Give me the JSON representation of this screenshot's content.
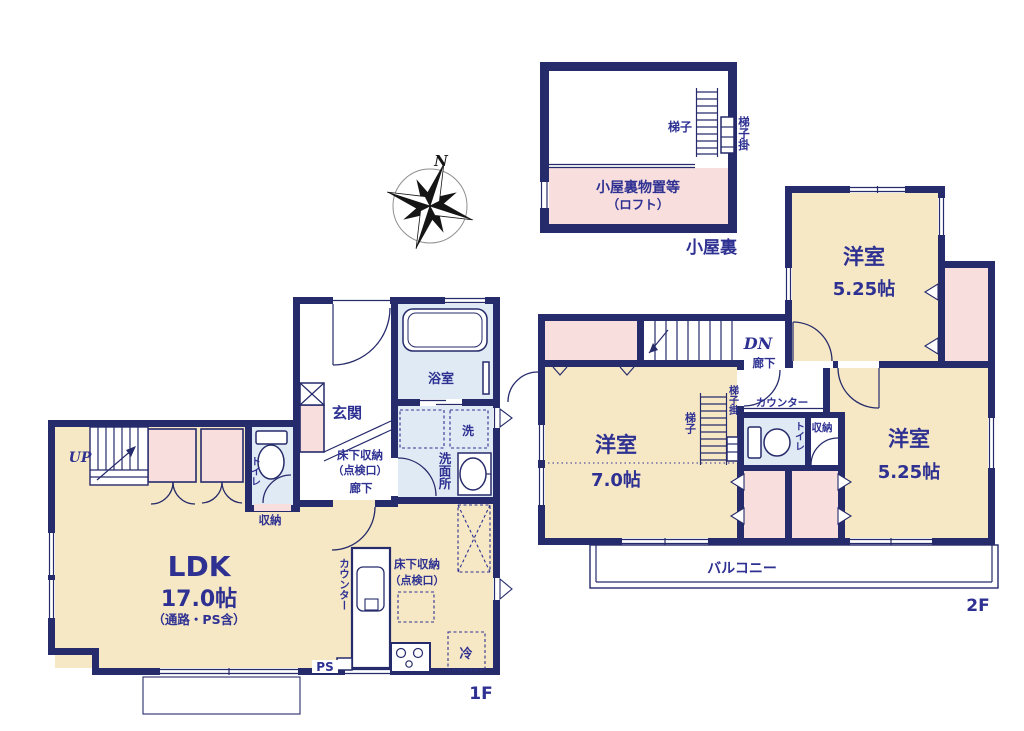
{
  "colors": {
    "wall": "#262b6b",
    "text": "#2e3192",
    "room_cream": "#f6e8c5",
    "closet_pink": "#f8dfde",
    "wet_area_blue": "#dfeaf4",
    "compass_black": "#151515"
  },
  "compass": {
    "north_label": "N"
  },
  "attic": {
    "name_label": "小屋裏",
    "storage_label": "小屋裏物置等",
    "storage_sub_label": "（ロフト）",
    "ladder_label": "梯子",
    "ladder_hook_label": "梯子掛"
  },
  "floor2": {
    "name_label": "2F",
    "rooms": [
      {
        "name": "洋室",
        "size": "5.25帖"
      },
      {
        "name": "洋室",
        "size": "7.0帖"
      },
      {
        "name": "洋室",
        "size": "5.25帖"
      }
    ],
    "stairs_label": "DN",
    "hallway_label": "廊下",
    "counter_label": "カウンター",
    "toilet_label": "トイレ",
    "closet_label": "収納",
    "ladder_label": "梯子",
    "ladder_hook_label": "梯子掛",
    "balcony_label": "バルコニー"
  },
  "floor1": {
    "name_label": "1F",
    "ldk": {
      "name": "LDK",
      "size": "17.0帖",
      "note": "（通路・PS含）"
    },
    "stairs_label": "UP",
    "entrance_label": "玄関",
    "bath_label": "浴室",
    "washer_label": "洗",
    "washroom_label": "洗面所",
    "underfloor_storage_label_1": "床下収納",
    "underfloor_storage_label_2": "（点検口）",
    "hallway_label": "廊下",
    "toilet_label": "トイレ",
    "closet_label": "収納",
    "counter_label": "カウンター",
    "kitchen_underfloor_label_1": "床下収納",
    "kitchen_underfloor_label_2": "（点検口）",
    "fridge_label": "冷",
    "ps_label": "PS"
  }
}
